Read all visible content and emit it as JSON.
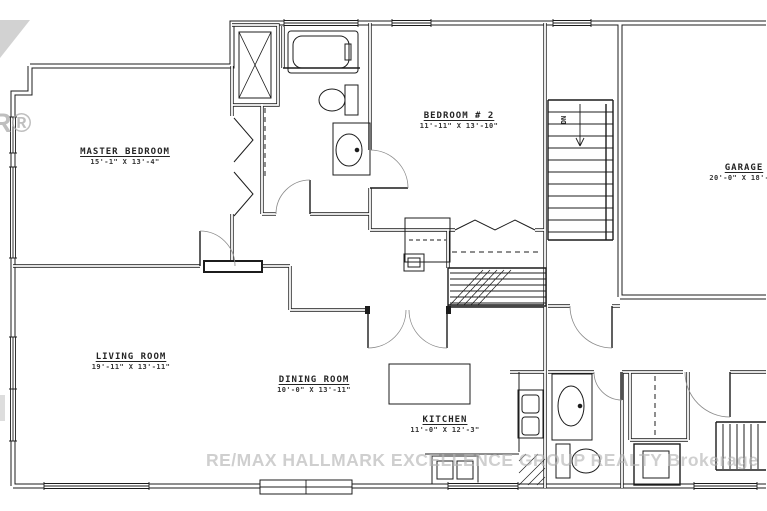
{
  "plan": {
    "rooms": [
      {
        "id": "master-bedroom",
        "name": "MASTER BEDROOM",
        "dims": "15'-1\" X 13'-4\""
      },
      {
        "id": "bedroom-2",
        "name": "BEDROOM # 2",
        "dims": "11'-11\" X 13'-10\""
      },
      {
        "id": "garage",
        "name": "GARAGE",
        "dims": "20'-0\" X 18'-2\""
      },
      {
        "id": "living-room",
        "name": "LIVING ROOM",
        "dims": "19'-11\" X 13'-11\""
      },
      {
        "id": "dining-room",
        "name": "DINING ROOM",
        "dims": "10'-0\" X 13'-11\""
      },
      {
        "id": "kitchen",
        "name": "KITCHEN",
        "dims": "11'-0\" X 12'-3\""
      }
    ],
    "stairs_label": "DN"
  },
  "watermark": {
    "brokerage": "RE/MAX HALLMARK EXCELLENCE GROUP REALTY Brokerage",
    "logo_fragment": "R®"
  },
  "colors": {
    "line": "#1c1c1c",
    "watermark": "#b2b2b2",
    "background": "#ffffff"
  }
}
